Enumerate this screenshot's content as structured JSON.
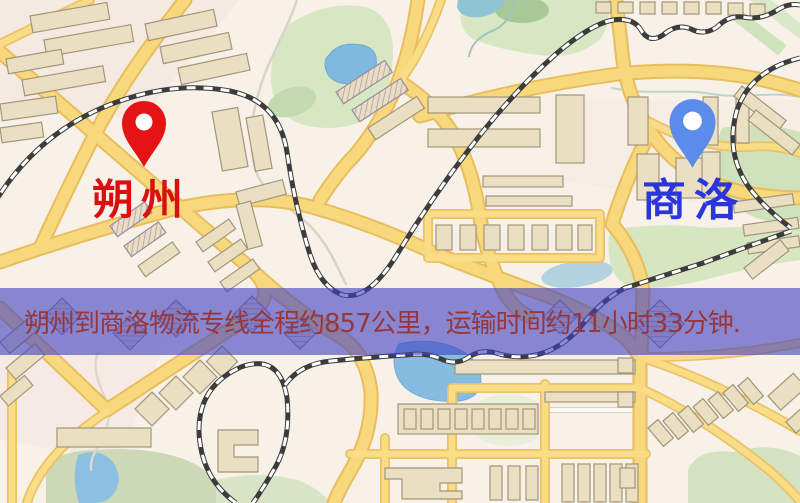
{
  "route": {
    "origin": {
      "name": "朔州",
      "label_color": "#da1010",
      "pin_color": "#e51313"
    },
    "destination": {
      "name": "商洛",
      "label_color": "#2a35db",
      "pin_color": "#5b8cec"
    },
    "banner": {
      "text": "朔州到商洛物流专线全程约857公里，运输时间约11小时33分钟.",
      "distance_km": "857",
      "duration_hours": "11",
      "duration_minutes": "33",
      "text_color": "#993639",
      "background_rgba": "rgba(64,64,193,0.60)"
    }
  },
  "map": {
    "icons": {
      "origin_pin": "location-pin-icon",
      "destination_pin": "location-pin-icon"
    },
    "theme": {
      "background": "#f7f1e8",
      "road_fill": "#f8d87d",
      "road_casing": "#e9bd5c",
      "building": "#ebdfc2",
      "park": "#d7e7c4",
      "water": "#7fb9de",
      "railway": "#3c3c3c"
    }
  }
}
